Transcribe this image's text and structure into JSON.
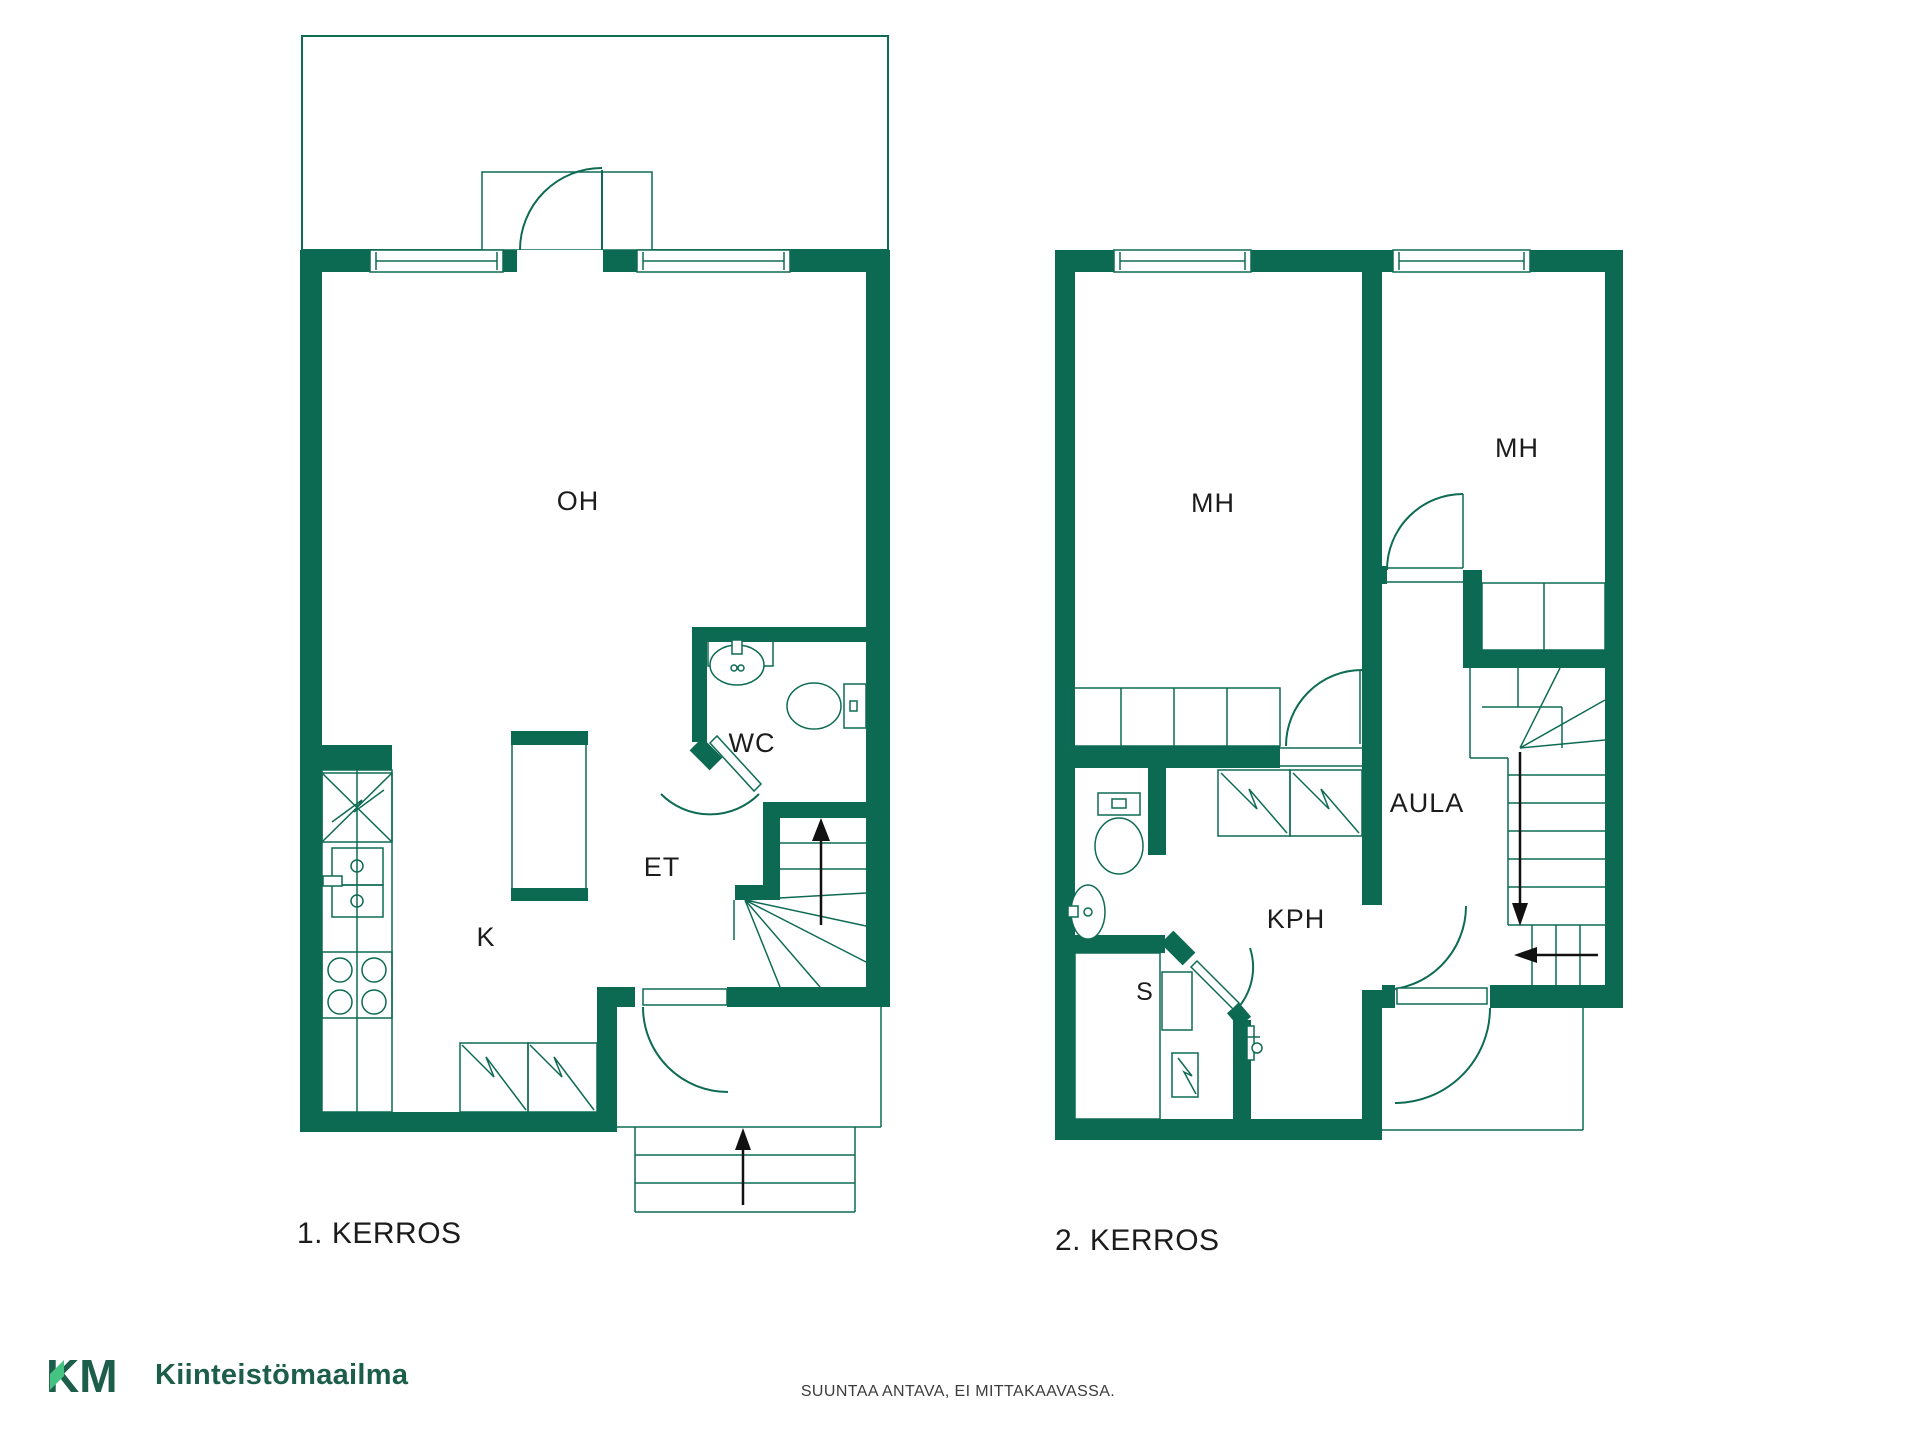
{
  "colors": {
    "wall": "#0C6A53",
    "line": "#0E6B54",
    "text": "#1C1C1C",
    "logo_dark": "#1C5E4A",
    "logo_light": "#45C382",
    "arrow": "#111111"
  },
  "floor1": {
    "title": "1. KERROS",
    "rooms": {
      "living": "OH",
      "kitchen": "K",
      "toilet": "WC",
      "entry": "ET"
    }
  },
  "floor2": {
    "title": "2. KERROS",
    "rooms": {
      "bedroom_left": "MH",
      "bedroom_right": "MH",
      "hall": "AULA",
      "bathroom": "KPH",
      "sauna": "S"
    }
  },
  "footer": {
    "brand_mark": "KM",
    "brand_name": "Kiinteistömaailma",
    "disclaimer": "SUUNTAA ANTAVA, EI MITTAKAAVASSA."
  }
}
